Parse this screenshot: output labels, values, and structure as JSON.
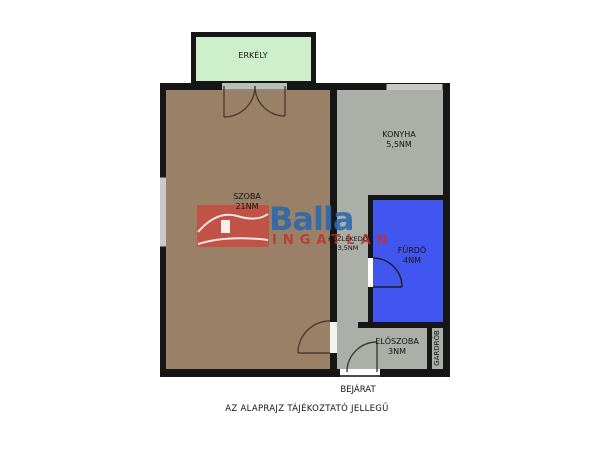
{
  "floorplan": {
    "rooms": [
      {
        "id": "erkely",
        "label": "ERKÉLY",
        "area": ""
      },
      {
        "id": "szoba",
        "label": "SZOBA",
        "area": "21NM"
      },
      {
        "id": "konyha",
        "label": "KONYHA",
        "area": "5,5NM"
      },
      {
        "id": "kozlekedo",
        "label": "KÖZLEKEDŐ",
        "area": "3,5NM"
      },
      {
        "id": "furdo",
        "label": "FÜRDŐ",
        "area": "4NM"
      },
      {
        "id": "eloszoba",
        "label": "ELŐSZOBA",
        "area": "3NM"
      },
      {
        "id": "gardrob",
        "label": "GARDRÓB",
        "area": ""
      }
    ],
    "entrance_label": "BEJÁRAT",
    "disclaimer": "AZ ALAPRAJZ TÁJÉKOZTATÓ JELLEGŰ"
  },
  "watermark": {
    "brand": "Balla",
    "word": "INGATLAN",
    "house_icon": "house-logo-icon"
  },
  "colors": {
    "wall": "#161616",
    "szoba_fill": "#9a8066",
    "gray_fill": "#abafa7",
    "furdo_fill": "#4156ee",
    "erkely_fill": "#cdf0cb",
    "brand_blue": "#2968b2",
    "brand_red": "#c13128"
  }
}
